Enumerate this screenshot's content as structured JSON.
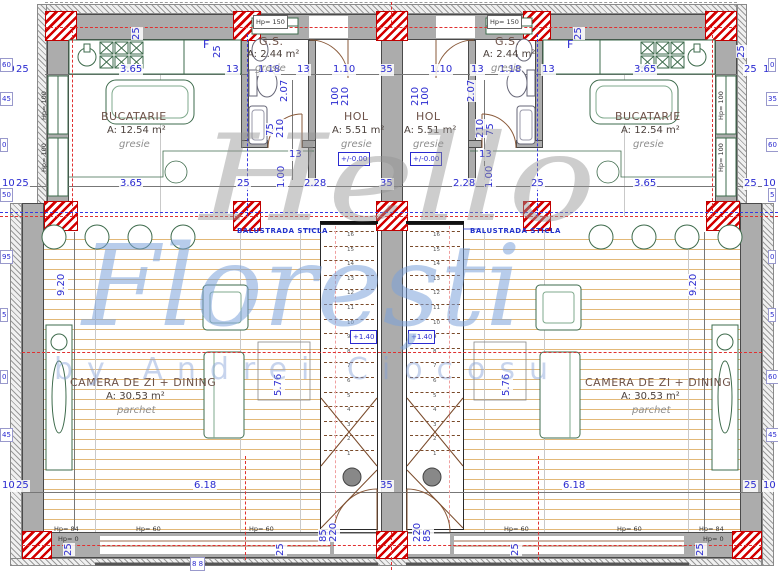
{
  "watermark": {
    "line1": "Hello",
    "line2": "Florești",
    "line3": "by Andrei Ciocosu"
  },
  "stairs": {
    "count": 16,
    "level_label": "+1.40"
  },
  "colors": {
    "dimension_blue": "#2a2ad0",
    "wall_gray": "#acacac",
    "column_red": "#d40000",
    "wood_floor": "#e2b878",
    "furniture_green": "#3e6b4c",
    "door_brown": "#8a5a3a",
    "axis_red": "#e03030",
    "axis_blue": "#3a3ae0",
    "watermark_gray": "#919191",
    "watermark_blue": "#7ca3da"
  },
  "rooms": {
    "kitchen": {
      "name": "BUCATARIE",
      "area": "A: 12.54 m²",
      "floor": "gresie"
    },
    "hol": {
      "name": "HOL",
      "area": "A: 5.51 m²",
      "floor": "gresie",
      "level": "+/-0.00"
    },
    "gs": {
      "name": "G.S.",
      "area": "A: 2.44 m²",
      "floor": "gresie"
    },
    "living": {
      "name": "CAMERA DE ZI + DINING",
      "area": "A: 30.53 m²",
      "floor": "parchet"
    }
  },
  "labels": [
    {
      "t": "10",
      "x": 1,
      "y": 64,
      "c": "d"
    },
    {
      "t": "25",
      "x": 15,
      "y": 64,
      "c": "d"
    },
    {
      "t": "3.65",
      "x": 119,
      "y": 64,
      "c": "d"
    },
    {
      "t": "13",
      "x": 225,
      "y": 64,
      "c": "d"
    },
    {
      "t": "1.18",
      "x": 257,
      "y": 64,
      "c": "d"
    },
    {
      "t": "13",
      "x": 296,
      "y": 64,
      "c": "d"
    },
    {
      "t": "1.10",
      "x": 332,
      "y": 64,
      "c": "d"
    },
    {
      "t": "35",
      "x": 379,
      "y": 64,
      "c": "d"
    },
    {
      "t": "1.10",
      "x": 429,
      "y": 64,
      "c": "d"
    },
    {
      "t": "13",
      "x": 470,
      "y": 64,
      "c": "d"
    },
    {
      "t": "1.18",
      "x": 498,
      "y": 64,
      "c": "d"
    },
    {
      "t": "13",
      "x": 541,
      "y": 64,
      "c": "d"
    },
    {
      "t": "3.65",
      "x": 633,
      "y": 64,
      "c": "d"
    },
    {
      "t": "25",
      "x": 743,
      "y": 64,
      "c": "d"
    },
    {
      "t": "10",
      "x": 762,
      "y": 64,
      "c": "d"
    },
    {
      "t": "10",
      "x": 1,
      "y": 178,
      "c": "d"
    },
    {
      "t": "25",
      "x": 15,
      "y": 178,
      "c": "d"
    },
    {
      "t": "3.65",
      "x": 119,
      "y": 178,
      "c": "d"
    },
    {
      "t": "25",
      "x": 236,
      "y": 178,
      "c": "d"
    },
    {
      "t": "2.28",
      "x": 303,
      "y": 178,
      "c": "d"
    },
    {
      "t": "35",
      "x": 379,
      "y": 178,
      "c": "d"
    },
    {
      "t": "2.28",
      "x": 452,
      "y": 178,
      "c": "d"
    },
    {
      "t": "25",
      "x": 530,
      "y": 178,
      "c": "d"
    },
    {
      "t": "3.65",
      "x": 633,
      "y": 178,
      "c": "d"
    },
    {
      "t": "25",
      "x": 743,
      "y": 178,
      "c": "d"
    },
    {
      "t": "10",
      "x": 762,
      "y": 178,
      "c": "d"
    },
    {
      "t": "10",
      "x": 1,
      "y": 480,
      "c": "d"
    },
    {
      "t": "25",
      "x": 15,
      "y": 480,
      "c": "d"
    },
    {
      "t": "6.18",
      "x": 193,
      "y": 480,
      "c": "d"
    },
    {
      "t": "35",
      "x": 379,
      "y": 480,
      "c": "d"
    },
    {
      "t": "6.18",
      "x": 562,
      "y": 480,
      "c": "d"
    },
    {
      "t": "25",
      "x": 743,
      "y": 480,
      "c": "d"
    },
    {
      "t": "10",
      "x": 762,
      "y": 480,
      "c": "d"
    },
    {
      "t": "13",
      "x": 288,
      "y": 149,
      "c": "d"
    },
    {
      "t": "13",
      "x": 478,
      "y": 149,
      "c": "d"
    },
    {
      "t": "2.07",
      "x": 291,
      "y": 102,
      "c": "dv"
    },
    {
      "t": "2.07",
      "x": 478,
      "y": 102,
      "c": "dv"
    },
    {
      "t": "75",
      "x": 277,
      "y": 136,
      "c": "dv"
    },
    {
      "t": "210",
      "x": 287,
      "y": 138,
      "c": "dv"
    },
    {
      "t": "210",
      "x": 487,
      "y": 138,
      "c": "dv"
    },
    {
      "t": "75",
      "x": 497,
      "y": 136,
      "c": "dv"
    },
    {
      "t": "100",
      "x": 342,
      "y": 106,
      "c": "dv"
    },
    {
      "t": "210",
      "x": 352,
      "y": 106,
      "c": "dv"
    },
    {
      "t": "210",
      "x": 422,
      "y": 106,
      "c": "dv"
    },
    {
      "t": "100",
      "x": 432,
      "y": 106,
      "c": "dv"
    },
    {
      "t": "1.00",
      "x": 288,
      "y": 188,
      "c": "dv"
    },
    {
      "t": "1.00",
      "x": 496,
      "y": 188,
      "c": "dv"
    },
    {
      "t": "9.20",
      "x": 68,
      "y": 296,
      "c": "dv"
    },
    {
      "t": "9.20",
      "x": 700,
      "y": 296,
      "c": "dv"
    },
    {
      "t": "5.76",
      "x": 285,
      "y": 396,
      "c": "dv"
    },
    {
      "t": "5.76",
      "x": 513,
      "y": 396,
      "c": "dv"
    },
    {
      "t": "85",
      "x": 330,
      "y": 542,
      "c": "dv"
    },
    {
      "t": "220",
      "x": 340,
      "y": 542,
      "c": "dv"
    },
    {
      "t": "220",
      "x": 424,
      "y": 542,
      "c": "dv"
    },
    {
      "t": "85",
      "x": 434,
      "y": 542,
      "c": "dv"
    },
    {
      "t": "25",
      "x": 143,
      "y": 40,
      "c": "dv"
    },
    {
      "t": "25",
      "x": 224,
      "y": 58,
      "c": "dv"
    },
    {
      "t": "25",
      "x": 585,
      "y": 40,
      "c": "dv"
    },
    {
      "t": "25",
      "x": 748,
      "y": 58,
      "c": "dv"
    },
    {
      "t": "25",
      "x": 75,
      "y": 556,
      "c": "dv"
    },
    {
      "t": "25",
      "x": 287,
      "y": 556,
      "c": "dv"
    },
    {
      "t": "25",
      "x": 522,
      "y": 556,
      "c": "dv"
    },
    {
      "t": "25",
      "x": 707,
      "y": 556,
      "c": "dv"
    },
    {
      "t": "Hp= 150",
      "x": 253,
      "y": 15,
      "c": "hb"
    },
    {
      "t": "Hp= 150",
      "x": 487,
      "y": 15,
      "c": "hb"
    },
    {
      "t": "Hp= 100",
      "x": 50,
      "y": 120,
      "c": "hv"
    },
    {
      "t": "Hp= 100",
      "x": 50,
      "y": 172,
      "c": "hv"
    },
    {
      "t": "Hp= 100",
      "x": 727,
      "y": 120,
      "c": "hv"
    },
    {
      "t": "Hp= 100",
      "x": 727,
      "y": 172,
      "c": "hv"
    },
    {
      "t": "Hp= 84",
      "x": 54,
      "y": 523,
      "c": "h"
    },
    {
      "t": "Hp= 0",
      "x": 58,
      "y": 533,
      "c": "h"
    },
    {
      "t": "Hp= 60",
      "x": 136,
      "y": 523,
      "c": "h"
    },
    {
      "t": "Hp= 60",
      "x": 249,
      "y": 523,
      "c": "h"
    },
    {
      "t": "Hp= 60",
      "x": 504,
      "y": 523,
      "c": "h"
    },
    {
      "t": "Hp= 60",
      "x": 617,
      "y": 523,
      "c": "h"
    },
    {
      "t": "Hp= 84",
      "x": 699,
      "y": 523,
      "c": "h"
    },
    {
      "t": "Hp= 0",
      "x": 703,
      "y": 533,
      "c": "h"
    },
    {
      "t": "BUCATARIE",
      "x": 101,
      "y": 111,
      "c": "rt"
    },
    {
      "t": "A: 12.54 m²",
      "x": 107,
      "y": 125,
      "c": "ra"
    },
    {
      "t": "gresie",
      "x": 119,
      "y": 139,
      "c": "rf"
    },
    {
      "t": "BUCATARIE",
      "x": 615,
      "y": 111,
      "c": "rt"
    },
    {
      "t": "A: 12.54 m²",
      "x": 621,
      "y": 125,
      "c": "ra"
    },
    {
      "t": "gresie",
      "x": 633,
      "y": 139,
      "c": "rf"
    },
    {
      "t": "HOL",
      "x": 344,
      "y": 111,
      "c": "rt"
    },
    {
      "t": "A: 5.51 m²",
      "x": 332,
      "y": 125,
      "c": "ra"
    },
    {
      "t": "gresie",
      "x": 341,
      "y": 139,
      "c": "rf"
    },
    {
      "t": "+/-0.00",
      "x": 338,
      "y": 152,
      "c": "lv"
    },
    {
      "t": "HOL",
      "x": 416,
      "y": 111,
      "c": "rt"
    },
    {
      "t": "A: 5.51 m²",
      "x": 404,
      "y": 125,
      "c": "ra"
    },
    {
      "t": "gresie",
      "x": 413,
      "y": 139,
      "c": "rf"
    },
    {
      "t": "+/-0.00",
      "x": 410,
      "y": 152,
      "c": "lv"
    },
    {
      "t": "G.S.",
      "x": 259,
      "y": 36,
      "c": "rt"
    },
    {
      "t": "A: 2.44 m²",
      "x": 247,
      "y": 49,
      "c": "ra"
    },
    {
      "t": "gresie",
      "x": 255,
      "y": 63,
      "c": "rf"
    },
    {
      "t": "G.S.",
      "x": 495,
      "y": 36,
      "c": "rt"
    },
    {
      "t": "A: 2.44 m²",
      "x": 483,
      "y": 49,
      "c": "ra"
    },
    {
      "t": "gresie",
      "x": 491,
      "y": 63,
      "c": "rf"
    },
    {
      "t": "CAMERA DE ZI + DINING",
      "x": 70,
      "y": 377,
      "c": "rt"
    },
    {
      "t": "A: 30.53 m²",
      "x": 106,
      "y": 391,
      "c": "ra"
    },
    {
      "t": "parchet",
      "x": 117,
      "y": 405,
      "c": "rf"
    },
    {
      "t": "CAMERA DE ZI + DINING",
      "x": 585,
      "y": 377,
      "c": "rt"
    },
    {
      "t": "A: 30.53 m²",
      "x": 621,
      "y": 391,
      "c": "ra"
    },
    {
      "t": "parchet",
      "x": 632,
      "y": 405,
      "c": "rf"
    },
    {
      "t": "F",
      "x": 203,
      "y": 39,
      "c": "f"
    },
    {
      "t": "F",
      "x": 567,
      "y": 39,
      "c": "f"
    },
    {
      "t": "BALUSTRADA STICLA",
      "x": 237,
      "y": 225,
      "c": "ba"
    },
    {
      "t": "BALUSTRADA STICLA",
      "x": 470,
      "y": 225,
      "c": "ba"
    },
    {
      "t": "+1.40",
      "x": 350,
      "y": 330,
      "c": "lv"
    },
    {
      "t": "+1.40",
      "x": 408,
      "y": 330,
      "c": "lv"
    },
    {
      "t": "60",
      "x": 0,
      "y": 58,
      "c": "dc"
    },
    {
      "t": "45",
      "x": 0,
      "y": 92,
      "c": "dc"
    },
    {
      "t": "0",
      "x": 0,
      "y": 138,
      "c": "dc"
    },
    {
      "t": "50",
      "x": 0,
      "y": 188,
      "c": "dc"
    },
    {
      "t": "95",
      "x": 0,
      "y": 250,
      "c": "dc"
    },
    {
      "t": "5",
      "x": 0,
      "y": 308,
      "c": "dc"
    },
    {
      "t": "0",
      "x": 0,
      "y": 370,
      "c": "dc"
    },
    {
      "t": "45",
      "x": 0,
      "y": 428,
      "c": "dc"
    },
    {
      "t": "0",
      "x": 768,
      "y": 58,
      "c": "dc"
    },
    {
      "t": "35",
      "x": 766,
      "y": 92,
      "c": "dc"
    },
    {
      "t": "60",
      "x": 766,
      "y": 138,
      "c": "dc"
    },
    {
      "t": "5",
      "x": 768,
      "y": 188,
      "c": "dc"
    },
    {
      "t": "0",
      "x": 768,
      "y": 250,
      "c": "dc"
    },
    {
      "t": "5",
      "x": 768,
      "y": 308,
      "c": "dc"
    },
    {
      "t": "60",
      "x": 766,
      "y": 370,
      "c": "dc"
    },
    {
      "t": "45",
      "x": 766,
      "y": 428,
      "c": "dc"
    },
    {
      "t": "8 8",
      "x": 190,
      "y": 557,
      "c": "dc"
    }
  ]
}
